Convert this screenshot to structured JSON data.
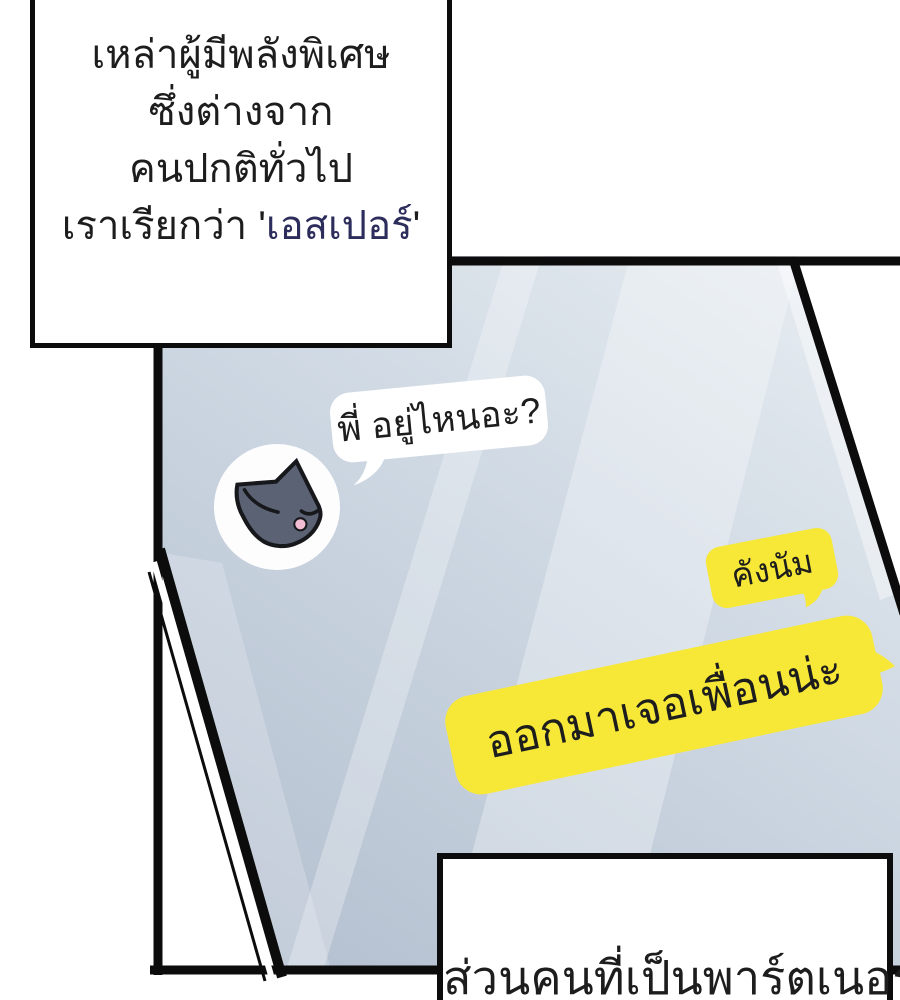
{
  "narration": {
    "lines": [
      "เหล่าผู้มีพลังพิเศษ",
      "ซึ่งต่างจาก",
      "คนปกติทั่วไป"
    ],
    "line4_prefix": "เราเรียกว่า '",
    "line4_accent": "เอสเปอร์",
    "line4_suffix": "'"
  },
  "chat": {
    "incoming": {
      "text": "พี่ อยู่ไหนอะ?",
      "avatar_icon": "cat"
    },
    "outgoing": [
      {
        "text": "คังนัม"
      },
      {
        "text": "ออกมาเจอเพื่อนน่ะ"
      }
    ]
  },
  "caption": {
    "text": "ส่วนคนที่เป็นพาร์ตเนอร์"
  },
  "colors": {
    "panel-line": "#0c0c0c",
    "screen-top": "#e5ebf0",
    "screen-mid": "#cdd7e2",
    "screen-bottom": "#b4c0d0",
    "bubble-yellow": "#f7e838",
    "bubble-white": "#ffffff",
    "text-dark": "#1d1d1d",
    "accent-navy": "#2d2d5c",
    "cat-gray": "#5a6273",
    "cat-tongue": "#f2bcd3",
    "avatar-bg": "#fdfdfe"
  }
}
